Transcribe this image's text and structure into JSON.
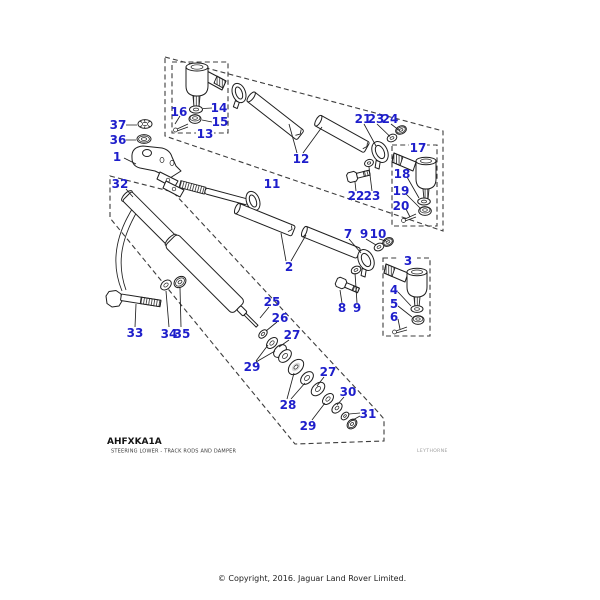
{
  "document": {
    "drawing_code": "AHFXKA1A",
    "drawing_title": "STEERING LOWER - TRACK RODS AND DAMPER",
    "watermark": "LEYTHORNE",
    "copyright": "© Copyright, 2016. Jaguar Land Rover Limited."
  },
  "colors": {
    "callout": "#1e1ecb",
    "line": "#1f1f1f",
    "boundary": "#3c3c3c"
  },
  "callouts": [
    {
      "text": "1",
      "x": 117,
      "y": 157,
      "boxed": false
    },
    {
      "text": "2",
      "x": 289,
      "y": 267,
      "boxed": false
    },
    {
      "text": "3",
      "x": 408,
      "y": 261,
      "boxed": true
    },
    {
      "text": "4",
      "x": 394,
      "y": 290,
      "boxed": false
    },
    {
      "text": "5",
      "x": 394,
      "y": 304,
      "boxed": false
    },
    {
      "text": "6",
      "x": 394,
      "y": 317,
      "boxed": false
    },
    {
      "text": "7",
      "x": 348,
      "y": 234,
      "boxed": false
    },
    {
      "text": "8",
      "x": 342,
      "y": 308,
      "boxed": false
    },
    {
      "text": "9",
      "x": 364,
      "y": 234,
      "boxed": false
    },
    {
      "text": "9",
      "x": 357,
      "y": 308,
      "boxed": false
    },
    {
      "text": "10",
      "x": 378,
      "y": 234,
      "boxed": false
    },
    {
      "text": "11",
      "x": 272,
      "y": 184,
      "boxed": false
    },
    {
      "text": "12",
      "x": 301,
      "y": 159,
      "boxed": false
    },
    {
      "text": "13",
      "x": 205,
      "y": 134,
      "boxed": true
    },
    {
      "text": "14",
      "x": 219,
      "y": 108,
      "boxed": false
    },
    {
      "text": "15",
      "x": 220,
      "y": 122,
      "boxed": false
    },
    {
      "text": "16",
      "x": 179,
      "y": 112,
      "boxed": false
    },
    {
      "text": "17",
      "x": 418,
      "y": 148,
      "boxed": true
    },
    {
      "text": "18",
      "x": 402,
      "y": 174,
      "boxed": false
    },
    {
      "text": "19",
      "x": 401,
      "y": 191,
      "boxed": false
    },
    {
      "text": "20",
      "x": 401,
      "y": 206,
      "boxed": false
    },
    {
      "text": "21",
      "x": 363,
      "y": 119,
      "boxed": false
    },
    {
      "text": "22",
      "x": 356,
      "y": 196,
      "boxed": false
    },
    {
      "text": "23",
      "x": 376,
      "y": 119,
      "boxed": false
    },
    {
      "text": "23",
      "x": 372,
      "y": 196,
      "boxed": false
    },
    {
      "text": "24",
      "x": 390,
      "y": 119,
      "boxed": false
    },
    {
      "text": "25",
      "x": 272,
      "y": 302,
      "boxed": false
    },
    {
      "text": "26",
      "x": 280,
      "y": 318,
      "boxed": false
    },
    {
      "text": "27",
      "x": 292,
      "y": 335,
      "boxed": false
    },
    {
      "text": "27",
      "x": 328,
      "y": 372,
      "boxed": false
    },
    {
      "text": "28",
      "x": 288,
      "y": 405,
      "boxed": false
    },
    {
      "text": "29",
      "x": 252,
      "y": 367,
      "boxed": false
    },
    {
      "text": "29",
      "x": 308,
      "y": 426,
      "boxed": false
    },
    {
      "text": "30",
      "x": 348,
      "y": 392,
      "boxed": false
    },
    {
      "text": "31",
      "x": 368,
      "y": 414,
      "boxed": false
    },
    {
      "text": "32",
      "x": 120,
      "y": 184,
      "boxed": false
    },
    {
      "text": "33",
      "x": 135,
      "y": 333,
      "boxed": false
    },
    {
      "text": "34",
      "x": 169,
      "y": 334,
      "boxed": false
    },
    {
      "text": "35",
      "x": 182,
      "y": 334,
      "boxed": false
    },
    {
      "text": "36",
      "x": 118,
      "y": 140,
      "boxed": false
    },
    {
      "text": "37",
      "x": 118,
      "y": 125,
      "boxed": false
    }
  ]
}
